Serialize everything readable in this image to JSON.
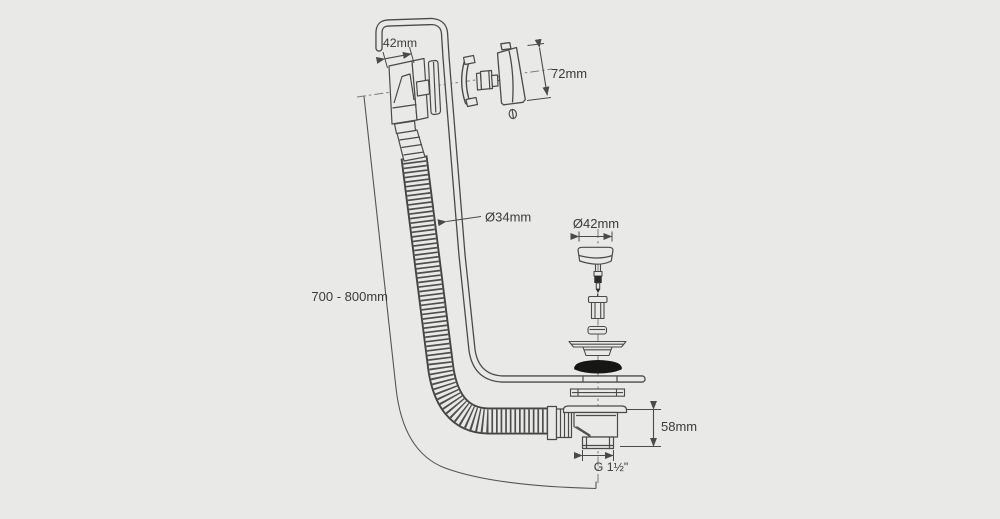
{
  "diagram": {
    "background_color": "#e9e9e7",
    "line_color": "#4a4a4a",
    "text_color": "#3a3a3a",
    "seal_color": "#161616",
    "annotations": {
      "overflow_width": "42mm",
      "overflow_cap_height": "72mm",
      "hose_diameter": "Ø34mm",
      "plug_diameter": "Ø42mm",
      "installation_length": "700 - 800mm",
      "waste_body_height": "58mm",
      "outlet_thread": "G 1½\""
    }
  }
}
